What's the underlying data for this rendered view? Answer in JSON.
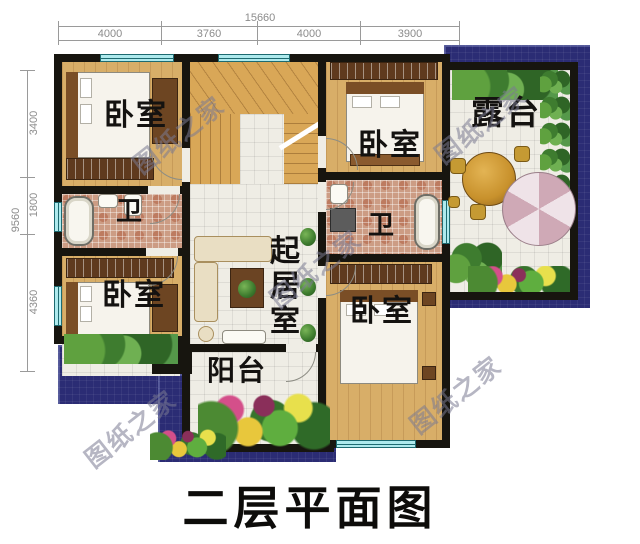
{
  "page_title": "二层平面图",
  "watermark_text": "图纸之家",
  "dimensions": {
    "top_total": "15660",
    "top_segments": [
      "4000",
      "3760",
      "4000",
      "3900"
    ],
    "left_total": "9560",
    "left_segments": [
      "3400",
      "1800",
      "4360"
    ]
  },
  "rooms": {
    "bedroom": "卧室",
    "bathroom": "卫",
    "living_room": "起居室",
    "balcony": "阳台",
    "terrace": "露台"
  },
  "colors": {
    "outdoor_blue": "#2b2c74",
    "wall_black": "#17150f",
    "wood_floor": "#d8ae68",
    "stair_wood": "#d9a757",
    "tile_white": "#efede5",
    "bath_mosaic": "#cc9c84",
    "window_cyan": "#aeeaed",
    "wardrobe_brown": "#5f3a1e"
  }
}
